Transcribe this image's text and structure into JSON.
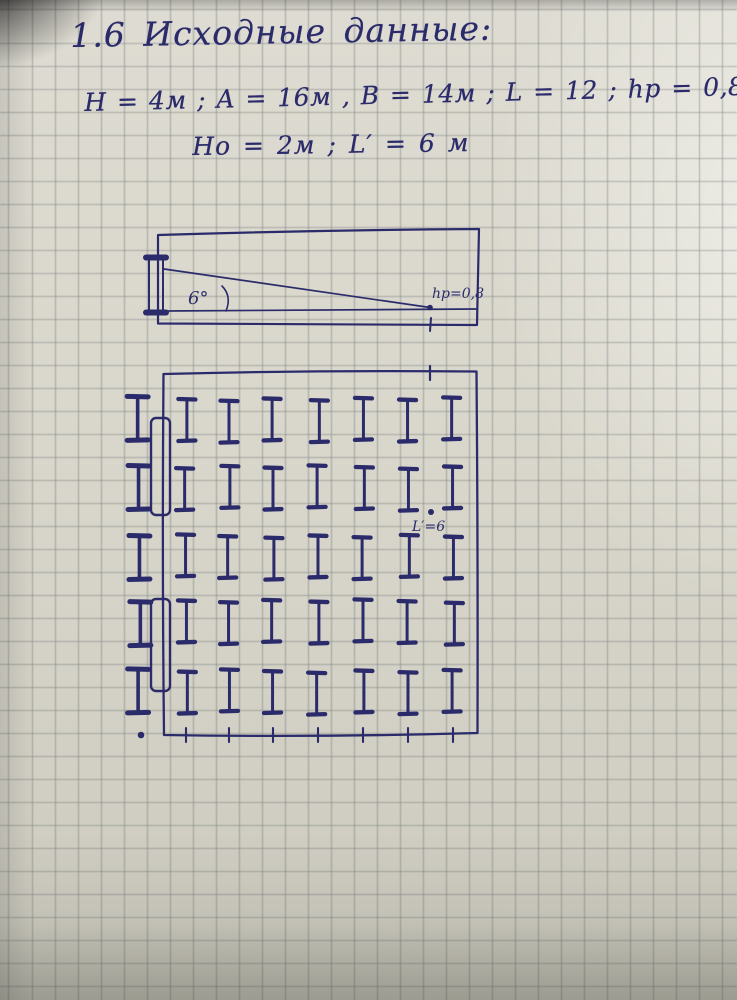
{
  "colors": {
    "ink": "#2b2b6b",
    "paper": "#d9d7cb",
    "grid_line": "#60686c"
  },
  "page": {
    "title": "1.6  Исходные данные:",
    "data_line_1": "H = 4м ;  A = 16м ,  B = 14м ;  L = 12 ;  hp = 0,8м",
    "data_line_2": "Hо = 2м ;   L′ = 6 м"
  },
  "side_view": {
    "angle_label": "6°",
    "point_label": "hp=0,8"
  },
  "plan_view": {
    "point_label": "L′=6",
    "cols_x": [
      139,
      186,
      229,
      273,
      318,
      363,
      408,
      453
    ],
    "rows_y": [
      420,
      488,
      557,
      622,
      692
    ],
    "outside_col_index": 0,
    "fixtures": [
      {
        "x": 151,
        "y": 418,
        "w": 19,
        "h": 97
      },
      {
        "x": 151,
        "y": 599,
        "w": 19,
        "h": 92
      }
    ],
    "bottom_ticks_x": [
      186,
      229,
      273,
      318,
      363,
      408,
      453
    ],
    "top_tick_x": 430,
    "spacing_dot": {
      "x": 431,
      "y": 512
    },
    "corner_dot": {
      "x": 141,
      "y": 735
    }
  }
}
